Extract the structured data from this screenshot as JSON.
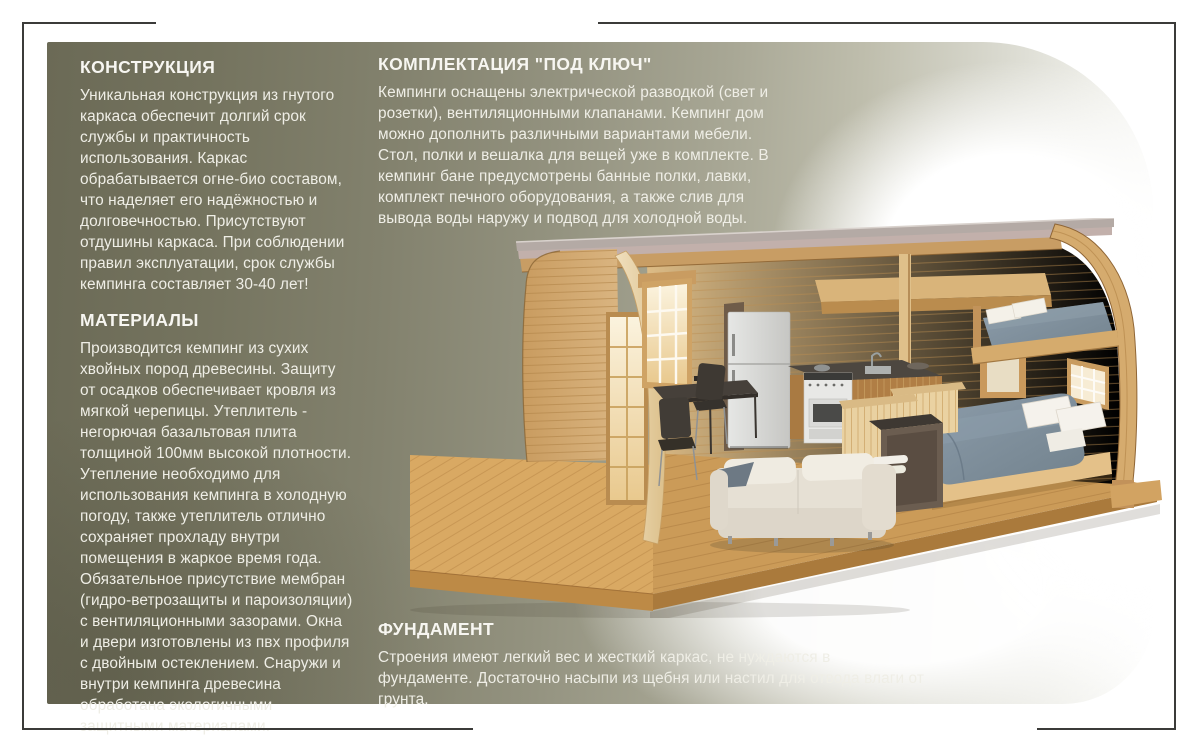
{
  "page": {
    "frame_color": "#3b3b39",
    "panel_color_left": "#6b6a56",
    "panel_color_right": "#ffffff",
    "heading_color": "#f7f6f1",
    "body_text_color": "#efeee6"
  },
  "sections": {
    "construction": {
      "title": "КОНСТРУКЦИЯ",
      "body": "Уникальная конструкция из гнутого каркаса обеспечит долгий срок службы и практичность использования. Каркас обрабатывается огне-био составом, что наделяет его надёжностью и долговечностью. Присутствуют отдушины каркаса. При соблюдении правил эксплуатации, срок службы кемпинга составляет 30-40 лет!"
    },
    "materials": {
      "title": "МАТЕРИАЛЫ",
      "body": "Производится кемпинг из сухих хвойных пород древесины. Защиту от осадков обеспечивает кровля из мягкой черепицы.  Утеплитель - негорючая базальтовая плита толщиной 100мм высокой плотности. Утепление необходимо для использования кемпинга в холодную погоду, также утеплитель отлично сохраняет прохладу внутри помещения в жаркое время года. Обязательное присутствие мембран (гидро-ветрозащиты и пароизоляции) с вентиляционными зазорами. Окна и двери изготовлены из пвх профиля с двойным остеклением. Снаружи и внутри кемпинга древесина обработана экологичными  защитными материалами."
    },
    "equipment": {
      "title": "КОМПЛЕКТАЦИЯ \"ПОД КЛЮЧ\"",
      "body": "Кемпинги оснащены электрической разводкой (свет и розетки), вентиляционными клапанами. Кемпинг дом можно дополнить различными вариантами мебели. Стол, полки и вешалка для вещей уже в комплекте. В кемпинг бане предусмотрены банные полки, лавки, комплект печного оборудования, а также слив для вывода воды наружу и подвод для холодной воды."
    },
    "foundation": {
      "title": "ФУНДАМЕНТ",
      "body": "Строения имеют легкий вес и жесткий каркас, не нуждаются в фундаменте. Достаточно насыпи из щебня или настил для отвода влаги от грунта."
    }
  }
}
